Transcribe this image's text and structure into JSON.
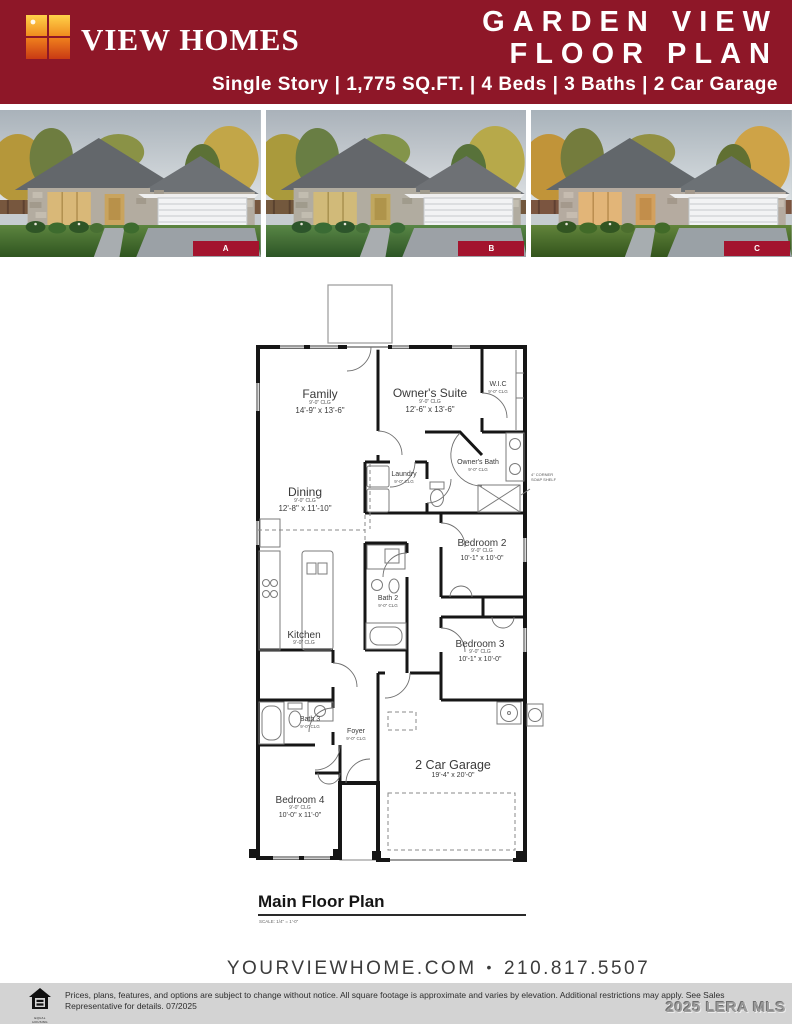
{
  "header": {
    "brand": "VIEW HOMES",
    "title_line1": "GARDEN VIEW",
    "title_line2": "FLOOR PLAN",
    "subtitle": "Single Story | 1,775 SQ.FT. | 4 Beds | 3 Baths | 2 Car Garage",
    "colors": {
      "maroon": "#8e1728",
      "photo_label_red": "#a3142e",
      "legal_bar_gray": "#d3d3d3"
    }
  },
  "photos": {
    "a": "A",
    "b": "B",
    "c": "C"
  },
  "floor_plan": {
    "title": "Main Floor Plan",
    "scale_note": "SCALE: 1/4\" = 1'-0\"",
    "rooms": {
      "family": {
        "name": "Family",
        "clg": "9'-0\" CLG",
        "dims": "14'-9\" x 13'-6\""
      },
      "owners_suite": {
        "name": "Owner's Suite",
        "clg": "9'-0\" CLG",
        "dims": "12'-6\" x 13'-6\""
      },
      "wic": {
        "name": "W.I.C",
        "clg": "9'-0\" CLG"
      },
      "laundry": {
        "name": "Laundry",
        "clg": "9'-0\" CLG"
      },
      "owners_bath": {
        "name": "Owner's Bath",
        "clg": "9'-0\" CLG"
      },
      "dining": {
        "name": "Dining",
        "clg": "9'-0\" CLG",
        "dims": "12'-8\" x 11'-10\""
      },
      "bedroom2": {
        "name": "Bedroom 2",
        "clg": "9'-0\" CLG",
        "dims": "10'-1\" x 10'-0\""
      },
      "bath2": {
        "name": "Bath 2",
        "clg": "9'-0\" CLG"
      },
      "kitchen": {
        "name": "Kitchen",
        "clg": "9'-0\" CLG"
      },
      "bedroom3": {
        "name": "Bedroom 3",
        "clg": "9'-0\" CLG",
        "dims": "10'-1\" x 10'-0\""
      },
      "bath3": {
        "name": "Bath 3",
        "clg": "9'-0\" CLG"
      },
      "foyer": {
        "name": "Foyer",
        "clg": "9'-0\" CLG"
      },
      "garage": {
        "name": "2 Car Garage",
        "dims": "19'-4\" x 20'-0\""
      },
      "bedroom4": {
        "name": "Bedroom 4",
        "clg": "9'-0\" CLG",
        "dims": "10'-0\" x 11'-0\""
      }
    },
    "annotation_line1": "4\" CORNER",
    "annotation_line2": "SOAP SHELF"
  },
  "footer": {
    "website": "YOURVIEWHOME.COM",
    "separator": "•",
    "phone": "210.817.5507"
  },
  "legal": {
    "line1": "Prices, plans, features, and options are subject to change without notice. All square footage is approximate and varies by elevation. Additional restrictions may apply. See Sales",
    "line2": "Representative for details. 07/2025",
    "eho_caption": "EQUAL HOUSING OPPORTUNITY"
  },
  "watermark": "2025 LERA MLS"
}
